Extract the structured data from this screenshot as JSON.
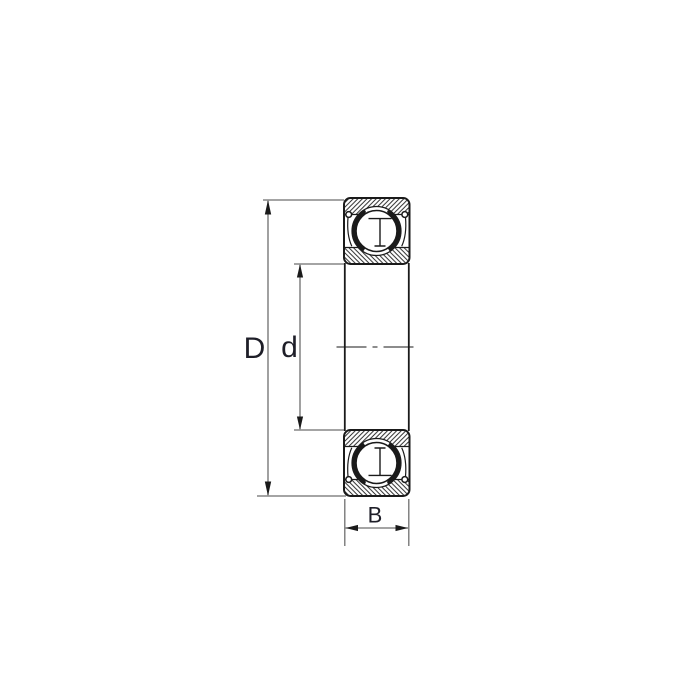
{
  "diagram": {
    "type": "bearing-cross-section-drawing",
    "description": "Shielded deep groove ball bearing cross-section with dimension callouts",
    "dimension_labels": {
      "outer_diameter": "D",
      "bore_diameter": "d",
      "width": "B"
    },
    "colors": {
      "background": "#ffffff",
      "drawing_line": "#1a1a1a",
      "dimension_line": "#6e6e6e",
      "label_text": "#1e1e28",
      "hatch": "#222222"
    }
  }
}
